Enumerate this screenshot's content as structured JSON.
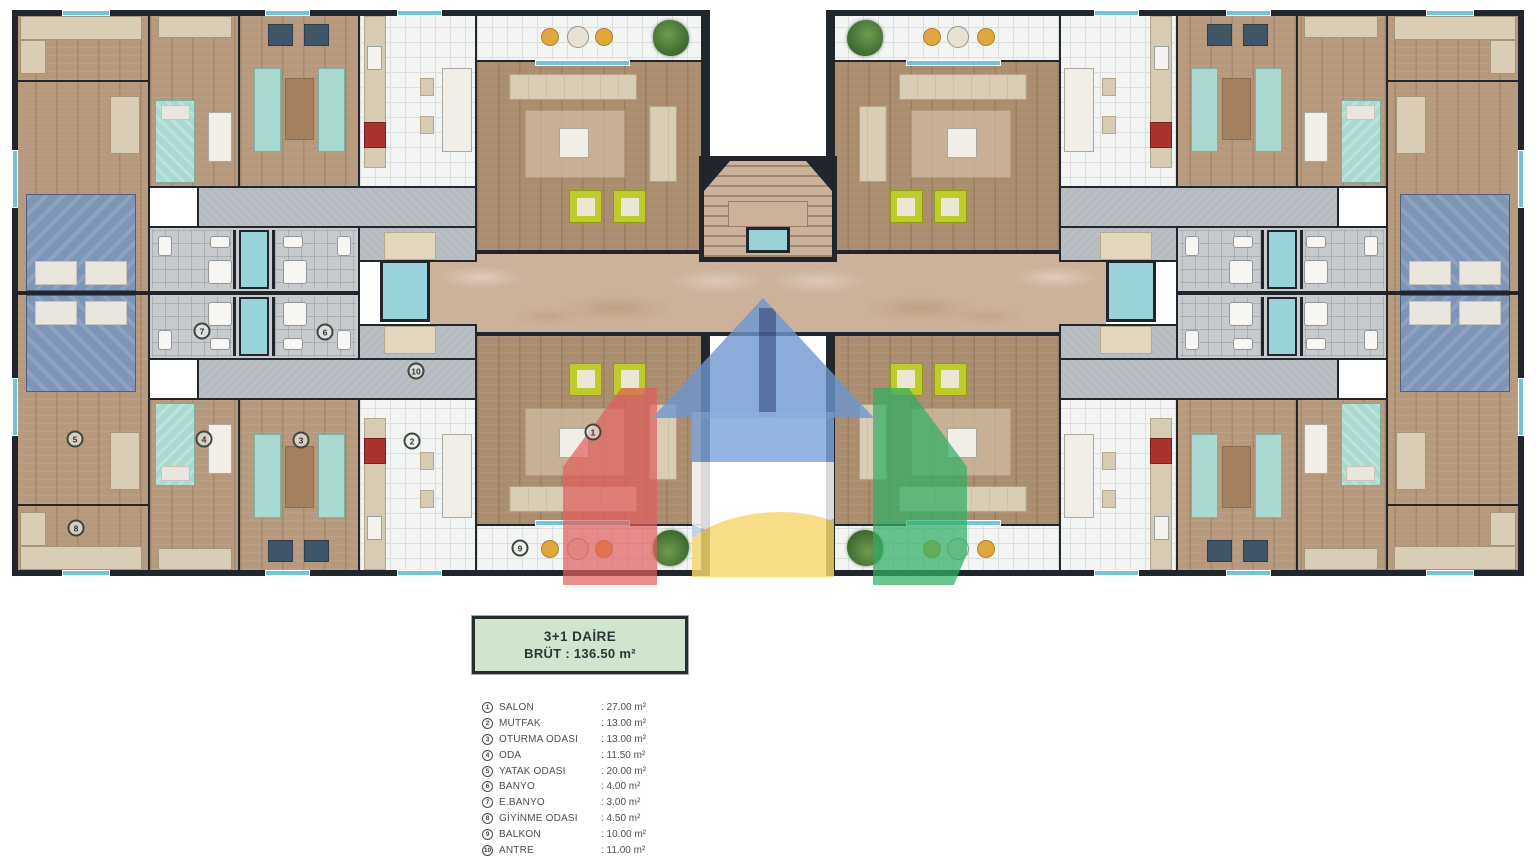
{
  "title_box": {
    "line1": "3+1 DAİRE",
    "line2": "BRÜT : 136.50 m²"
  },
  "legend": {
    "items": [
      {
        "num": "1",
        "name": "SALON",
        "area": ": 27.00 m²"
      },
      {
        "num": "2",
        "name": "MUTFAK",
        "area": ": 13.00 m²"
      },
      {
        "num": "3",
        "name": "OTURMA ODASI",
        "area": ": 13.00 m²"
      },
      {
        "num": "4",
        "name": "ODA",
        "area": ": 11.50 m²"
      },
      {
        "num": "5",
        "name": "YATAK ODASI",
        "area": ": 20.00 m²"
      },
      {
        "num": "6",
        "name": "BANYO",
        "area": ": 4.00 m²"
      },
      {
        "num": "7",
        "name": "E.BANYO",
        "area": ": 3.00 m²"
      },
      {
        "num": "8",
        "name": "GİYİNME ODASI",
        "area": ": 4.50 m²"
      },
      {
        "num": "9",
        "name": "BALKON",
        "area": ": 10.00 m²"
      },
      {
        "num": "10",
        "name": "ANTRE",
        "area": ": 11.00 m²"
      }
    ]
  },
  "plan": {
    "markers": [
      {
        "num": "1",
        "room": "salon",
        "x": 593,
        "y": 432
      },
      {
        "num": "2",
        "room": "mutfak",
        "x": 412,
        "y": 441
      },
      {
        "num": "3",
        "room": "oturma-odasi",
        "x": 301,
        "y": 440
      },
      {
        "num": "4",
        "room": "oda",
        "x": 204,
        "y": 439
      },
      {
        "num": "5",
        "room": "yatak-odasi",
        "x": 75,
        "y": 439
      },
      {
        "num": "6",
        "room": "banyo",
        "x": 325,
        "y": 332
      },
      {
        "num": "7",
        "room": "e-banyo",
        "x": 202,
        "y": 331
      },
      {
        "num": "8",
        "room": "giyinme-odasi",
        "x": 76,
        "y": 528
      },
      {
        "num": "9",
        "room": "balkon",
        "x": 520,
        "y": 548
      },
      {
        "num": "10",
        "room": "antre",
        "x": 416,
        "y": 371
      }
    ]
  },
  "colors": {
    "wood": "#b79a7d",
    "wood-dark": "#ab8d6f",
    "wall": "#20262b",
    "tile-white": "#f3f4f4",
    "tile-line": "#dcdedf",
    "tile-gray": "#c7cbce",
    "antre-gray": "#b5bac0",
    "marble": "#ccb29a",
    "window-teal": "#74c4d6",
    "shaft-teal": "#9ad2da",
    "furn-teal": "#a9d9d0",
    "chair-yellow": "#bfca2b",
    "chair-dark": "#3e5668",
    "bed-blue": "#7e95ba",
    "sofa-beige": "#d9cdb6",
    "rug-brown": "#a4805e",
    "counter-beige": "#d8cbb4",
    "doormat": "#e2d7bc",
    "stove-red": "#a8322c",
    "plant-green": "#4d7c3a",
    "balcony-chair": "#e0a83c",
    "logo-blue2": "#7ea6db",
    "logo-body": "#b9cdea",
    "logo-yellow": "#f6d66d",
    "logo-red": "#e15d5d",
    "logo-green": "#2faf64",
    "label-bg": "#cfe5cd"
  }
}
